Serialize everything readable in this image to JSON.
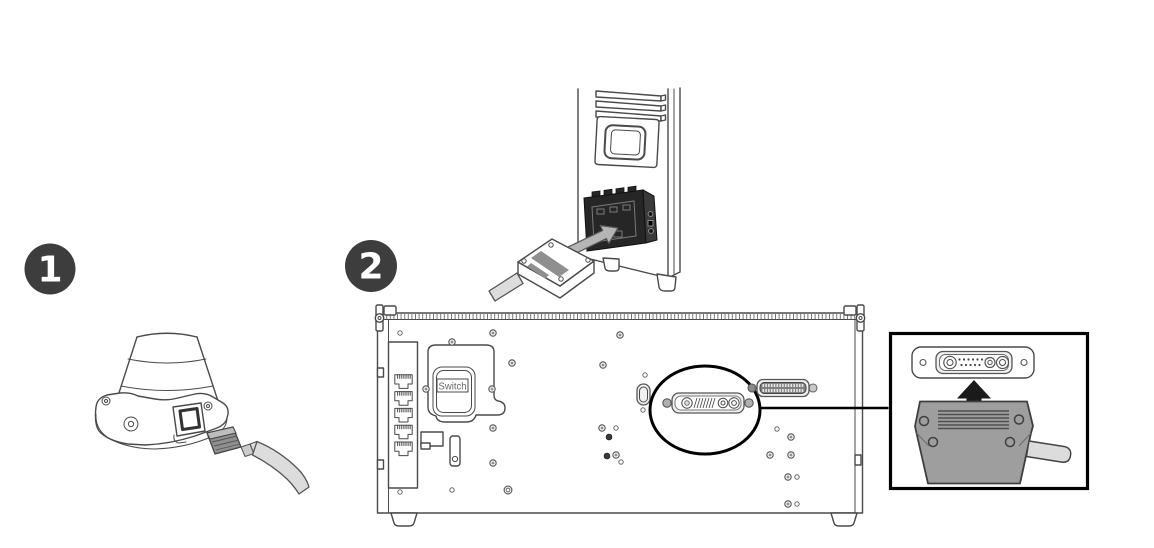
{
  "page": {
    "background": "#ffffff"
  },
  "colors": {
    "badge_bg": "#3d3d3d",
    "badge_text": "#ffffff",
    "outline": "#4a4a4a",
    "dark_panel": "#262626",
    "dark_panel_side": "#3a3a3a",
    "arrow_gray": "#b5b5b5",
    "arrow_black": "#1a1a1a",
    "housing_gray": "#9e9e9e",
    "plug_gray": "#8f8f8f",
    "label_gray": "#8f8f8f",
    "cable_gray": "#dcdcdc",
    "switch_text": "#666666",
    "callout_border": "#000000"
  },
  "steps": [
    {
      "number": "1",
      "illustration": "robot-base-cable-connection"
    },
    {
      "number": "2",
      "illustration": "pedestal-and-control-box-rear-panel-connection"
    }
  ],
  "control_box": {
    "switch_label": "Switch",
    "ethernet_ports": 5
  }
}
